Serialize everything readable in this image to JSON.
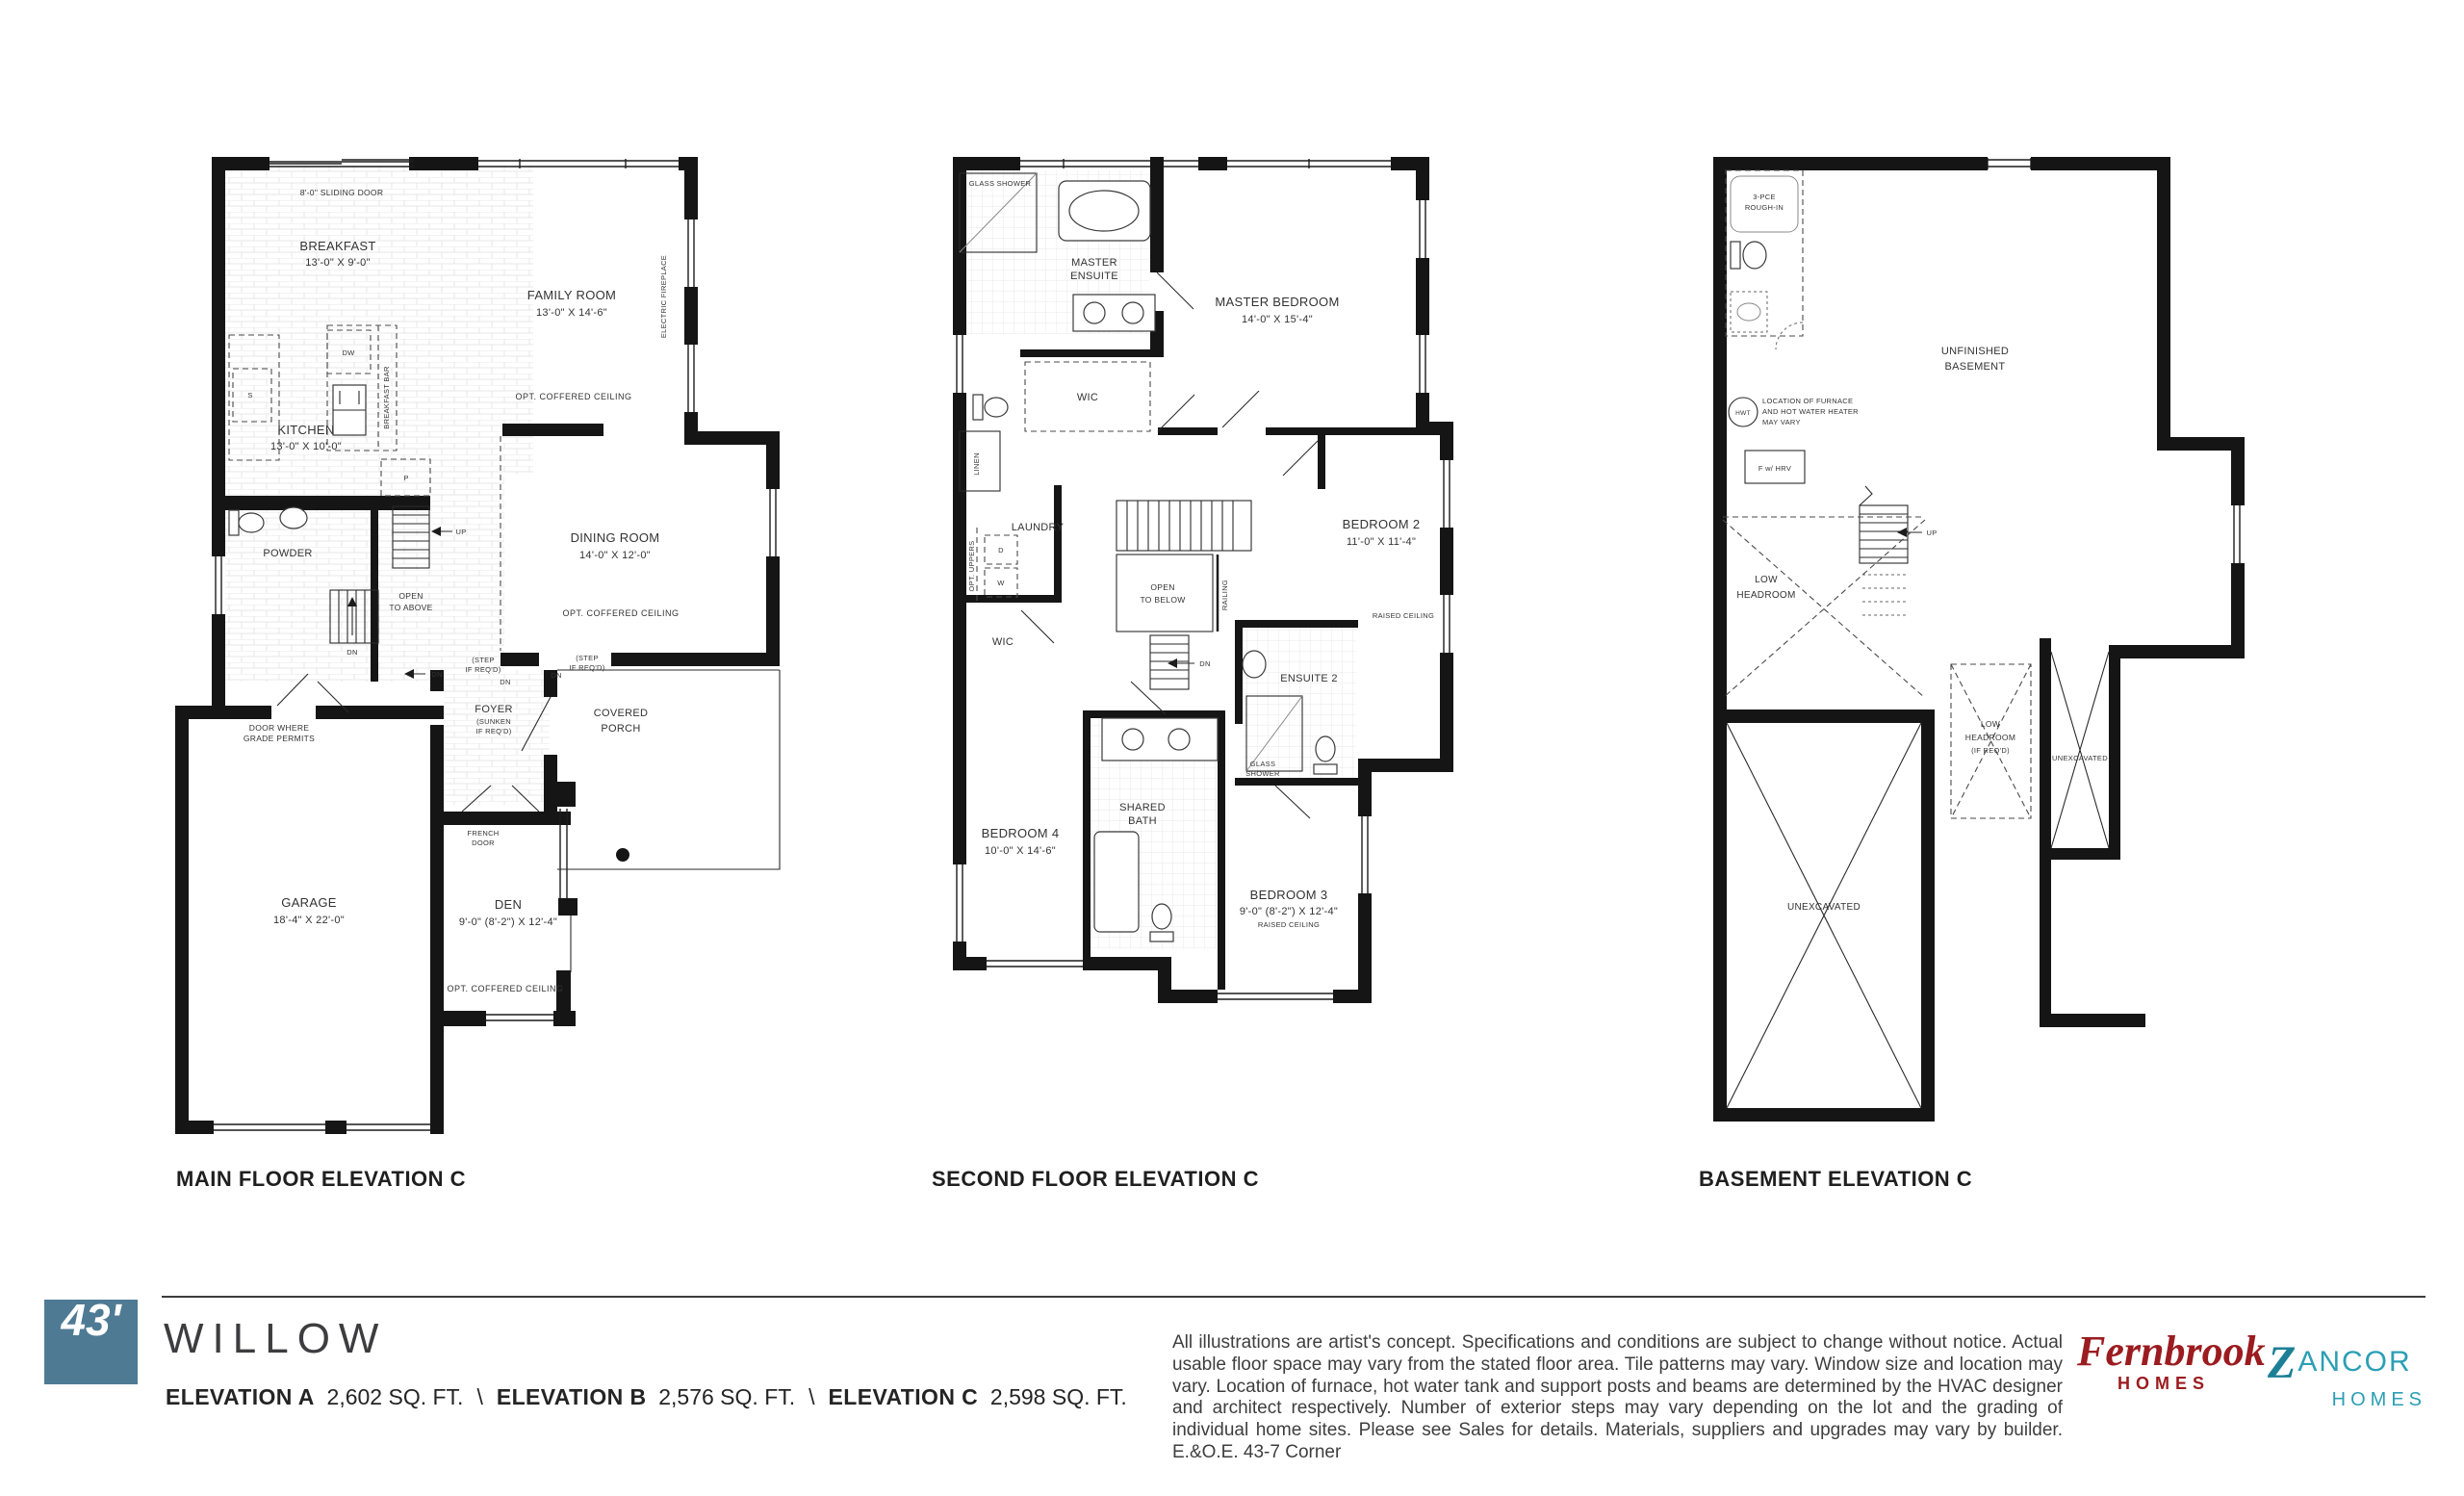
{
  "plans": {
    "main": {
      "caption": "MAIN FLOOR ELEVATION C",
      "sliding_door": "8'-0\" SLIDING DOOR",
      "breakfast": {
        "name": "BREAKFAST",
        "dims": "13'-0\" X 9'-0\""
      },
      "family_room": {
        "name": "FAMILY ROOM",
        "dims": "13'-0\" X 14'-6\"",
        "note": "OPT. COFFERED CEILING"
      },
      "electric_fireplace": "ELECTRIC FIREPLACE",
      "kitchen": {
        "name": "KITCHEN",
        "dims": "13'-0\" X 10'-0\""
      },
      "dining_room": {
        "name": "DINING ROOM",
        "dims": "14'-0\" X 12'-0\"",
        "note": "OPT. COFFERED CEILING"
      },
      "powder": "POWDER",
      "dw": "DW",
      "breakfast_bar": "BREAKFAST BAR",
      "sink_s": "S",
      "pantry_p": "P",
      "open_to_above": {
        "line1": "OPEN",
        "line2": "TO ABOVE"
      },
      "up": "UP",
      "dn": "DN",
      "step_if_reqd": {
        "line1": "(STEP",
        "line2": "IF REQ'D)"
      },
      "foyer": {
        "name": "FOYER",
        "note1": "(SUNKEN",
        "note2": "IF REQ'D)"
      },
      "covered_porch": {
        "line1": "COVERED",
        "line2": "PORCH"
      },
      "french_door": {
        "line1": "FRENCH",
        "line2": "DOOR"
      },
      "door_grade": {
        "line1": "DOOR WHERE",
        "line2": "GRADE PERMITS"
      },
      "garage": {
        "name": "GARAGE",
        "dims": "18'-4\" X 22'-0\""
      },
      "den": {
        "name": "DEN",
        "dims": "9'-0\" (8'-2\") X 12'-4\"",
        "note": "OPT. COFFERED CEILING"
      }
    },
    "second": {
      "caption": "SECOND FLOOR ELEVATION C",
      "glass_shower": "GLASS SHOWER",
      "glass_shower2": {
        "line1": "GLASS",
        "line2": "SHOWER"
      },
      "master_ensuite": {
        "line1": "MASTER",
        "line2": "ENSUITE"
      },
      "master_bedroom": {
        "name": "MASTER BEDROOM",
        "dims": "14'-0\" X 15'-4\""
      },
      "wic": "WIC",
      "linen": "LINEN",
      "laundry": "LAUNDRY",
      "opt_uppers": "OPT. UPPERS",
      "d": "D",
      "w": "W",
      "open_to_below": {
        "line1": "OPEN",
        "line2": "TO BELOW"
      },
      "railing": "RAILING",
      "dn": "DN",
      "bedroom2": {
        "name": "BEDROOM 2",
        "dims": "11'-0\" X 11'-4\"",
        "note": "RAISED CEILING"
      },
      "ensuite2": "ENSUITE 2",
      "shared_bath": {
        "line1": "SHARED",
        "line2": "BATH"
      },
      "bedroom4": {
        "name": "BEDROOM 4",
        "dims": "10'-0\" X 14'-6\""
      },
      "bedroom3": {
        "name": "BEDROOM 3",
        "dims": "9'-0\" (8'-2\") X 12'-4\"",
        "note": "RAISED CEILING"
      }
    },
    "basement": {
      "caption": "BASEMENT ELEVATION C",
      "rough_in": {
        "line1": "3-PCE",
        "line2": "ROUGH-IN"
      },
      "unfinished": {
        "line1": "UNFINISHED",
        "line2": "BASEMENT"
      },
      "hwt": "HWT",
      "furnace_note": {
        "line1": "LOCATION OF FURNACE",
        "line2": "AND HOT WATER HEATER",
        "line3": "MAY VARY"
      },
      "f_hrv": "F w/ HRV",
      "up": "UP",
      "low_headroom": {
        "line1": "LOW",
        "line2": "HEADROOM"
      },
      "low_headroom2": {
        "line1": "LOW",
        "line2": "HEADROOM",
        "line3": "(IF REQ'D)"
      },
      "unexcavated": "UNEXCAVATED"
    }
  },
  "footer": {
    "lot_badge": "43'",
    "model_name": "WILLOW",
    "separator": "\\",
    "elevations": [
      {
        "label": "ELEVATION A",
        "sqft": "2,602 SQ. FT."
      },
      {
        "label": "ELEVATION B",
        "sqft": "2,576 SQ. FT."
      },
      {
        "label": "ELEVATION C",
        "sqft": "2,598 SQ. FT."
      }
    ],
    "disclaimer": "All illustrations are artist's concept. Specifications and conditions are subject to change without notice. Actual usable floor space may vary from the stated floor area. Tile patterns may vary. Window size and location may vary. Location of furnace, hot water tank and support posts and beams are determined by the HVAC designer and architect respectively. Number of exterior steps may vary depending on the lot and the grading of individual home sites. Please see Sales for details. Materials, suppliers and upgrades may vary by builder. E.&O.E. 43-7 Corner",
    "fernbrook": {
      "name": "Fernbrook",
      "sub": "HOMES"
    },
    "zancor": {
      "z": "Z",
      "ancor": "ANCOR",
      "sub": "HOMES"
    }
  },
  "colors": {
    "badge": "#4e7a94",
    "fernbrook": "#9b1c20",
    "zancor": "#2b9fb4",
    "zancor_z": "#1d7f96"
  }
}
